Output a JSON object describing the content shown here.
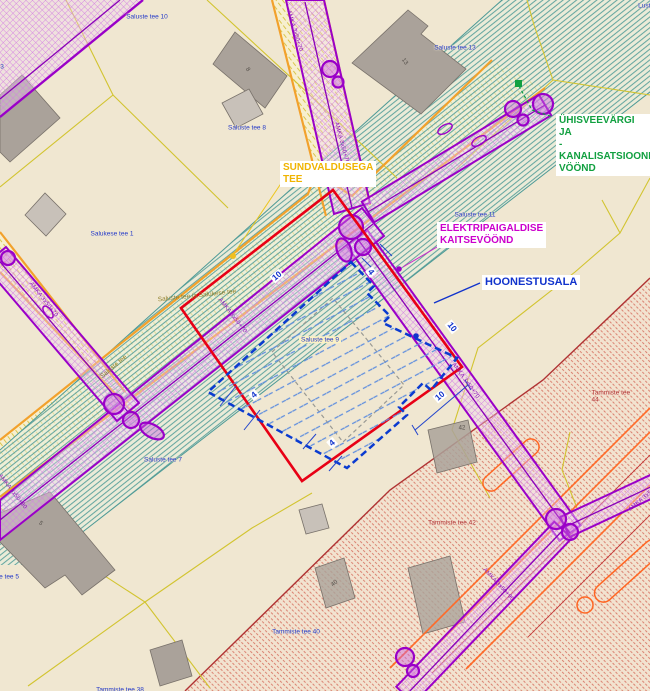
{
  "map": {
    "description": "Detail plan map view",
    "background_color": "#f0e7d1",
    "labels": [
      {
        "name": "parcel-saluste-tee-10",
        "type": "parcel",
        "text": "Saluste tee 10",
        "x": 147,
        "y": 17,
        "rot": 0
      },
      {
        "name": "parcel-saluste-tee-13",
        "type": "parcel",
        "text": "Saluste tee 13",
        "x": 455,
        "y": 48,
        "rot": 0
      },
      {
        "name": "parcel-saluste-tee-8",
        "type": "parcel",
        "text": "Saluste tee 8",
        "x": 247,
        "y": 128,
        "rot": 0
      },
      {
        "name": "parcel-salukese-tee-1",
        "type": "parcel",
        "text": "Salukese tee 1",
        "x": 112,
        "y": 234,
        "rot": 0
      },
      {
        "name": "parcel-saluste-tee-11",
        "type": "parcel",
        "text": "Saluste tee 11",
        "x": 475,
        "y": 215,
        "rot": 0
      },
      {
        "name": "parcel-saluste-tee-9",
        "type": "parcel-hl",
        "text": "Saluste tee 9",
        "x": 320,
        "y": 340,
        "rot": 0
      },
      {
        "name": "parcel-saluste-tee-7",
        "type": "parcel",
        "text": "Saluste tee 7",
        "x": 163,
        "y": 460,
        "rot": 0
      },
      {
        "name": "parcel-saluste-tee-5",
        "type": "parcel",
        "text": "Saluste tee 5",
        "x": 0,
        "y": 577,
        "rot": 0
      },
      {
        "name": "parcel-tammiste-tee-40",
        "type": "parcel",
        "text": "Tammiste tee 40",
        "x": 296,
        "y": 632,
        "rot": 0
      },
      {
        "name": "parcel-tammiste-tee-38",
        "type": "parcel",
        "text": "Tammiste tee 38",
        "x": 120,
        "y": 690,
        "rot": 0
      },
      {
        "name": "parcel-tammiste-tee-42",
        "type": "parcel-red",
        "text": "Tammiste tee 42",
        "x": 452,
        "y": 523,
        "rot": 0
      },
      {
        "name": "parcel-tammiste-tee-44",
        "type": "parcel-red",
        "text": "Tammiste tee 44",
        "x": 611,
        "y": 397,
        "rot": 0
      },
      {
        "name": "parcel-3-partial",
        "type": "parcel",
        "text": "3",
        "x": 2,
        "y": 67,
        "rot": 0
      },
      {
        "name": "parcel-lusti-partial",
        "type": "parcel",
        "text": "Lusti",
        "x": 645,
        "y": 6,
        "rot": 0
      },
      {
        "name": "road-name-saluste-tee",
        "type": "roadname",
        "text": "Saluste tee",
        "x": 114,
        "y": 367,
        "rot": -40
      },
      {
        "name": "road-name-saluste-ja-salukese",
        "type": "roadname",
        "text": "Saluste tee ja Salukese tee",
        "x": 197,
        "y": 296,
        "rot": -6
      },
      {
        "name": "cable-label-a1-top",
        "type": "cable",
        "text": "AMKA 3x50+70",
        "x": 294,
        "y": 31,
        "rot": 73
      },
      {
        "name": "cable-label-a1-mid",
        "type": "cable",
        "text": "AMKA 3x50+70",
        "x": 341,
        "y": 143,
        "rot": 75
      },
      {
        "name": "cable-label-c",
        "type": "cable",
        "text": "AMKA 3x50+70",
        "x": 43,
        "y": 300,
        "rot": 52
      },
      {
        "name": "cable-label-b-mid",
        "type": "cable",
        "text": "AMKA 3x50+70",
        "x": 232,
        "y": 316,
        "rot": 52
      },
      {
        "name": "cable-label-a2",
        "type": "cable",
        "text": "AMKA 3x50+70",
        "x": 465,
        "y": 381,
        "rot": 54
      },
      {
        "name": "cable-label-d2",
        "type": "cable",
        "text": "AMKA 3x50+90",
        "x": 498,
        "y": 585,
        "rot": 47
      },
      {
        "name": "cable-label-b-left",
        "type": "cable",
        "text": "AMKA 3x50+90",
        "x": 12,
        "y": 492,
        "rot": 52
      },
      {
        "name": "cable-label-d3",
        "type": "cable",
        "text": "AMKA 3x50+70",
        "x": 646,
        "y": 497,
        "rot": -40
      },
      {
        "name": "measure-10-nw",
        "type": "measure",
        "text": "10",
        "x": 277,
        "y": 276,
        "rot": -40
      },
      {
        "name": "measure-4-top",
        "type": "measure",
        "text": "4",
        "x": 371,
        "y": 272,
        "rot": 52
      },
      {
        "name": "measure-10-corridor",
        "type": "measure",
        "text": "10",
        "x": 452,
        "y": 327,
        "rot": 52
      },
      {
        "name": "measure-10-se",
        "type": "measure",
        "text": "10",
        "x": 440,
        "y": 396,
        "rot": -40
      },
      {
        "name": "measure-4-w",
        "type": "measure",
        "text": "4",
        "x": 254,
        "y": 395,
        "rot": -40
      },
      {
        "name": "measure-4-s",
        "type": "measure",
        "text": "4",
        "x": 332,
        "y": 443,
        "rot": -40
      },
      {
        "name": "callout-sundvaldusega-tee",
        "type": "callout callout-orange",
        "text": "SUNDVALDUSEGA\nTEE",
        "x": 280,
        "y": 161,
        "rot": 0,
        "anchor": "tl"
      },
      {
        "name": "callout-uhisveevargi",
        "type": "callout callout-green",
        "text": "ÜHISVEEVÄRGI\nJA\n-KANALISATSIOONI\nVÖÖND",
        "x": 556,
        "y": 114,
        "rot": 0,
        "anchor": "tl"
      },
      {
        "name": "callout-elektripaigaldise",
        "type": "callout callout-magenta",
        "text": "ELEKTRIPAIGALDISE\nKAITSEVÖÖND",
        "x": 437,
        "y": 222,
        "rot": 0,
        "anchor": "tl"
      },
      {
        "name": "callout-hoonestusala",
        "type": "callout callout-blue",
        "text": "HOONESTUSALA",
        "x": 482,
        "y": 275,
        "rot": 0,
        "anchor": "tl"
      },
      {
        "name": "building-number-13",
        "type": "bldgnum",
        "text": "13",
        "x": 404,
        "y": 62,
        "rot": 55
      },
      {
        "name": "building-number-5",
        "type": "bldgnum",
        "text": "5",
        "x": 40,
        "y": 524,
        "rot": 45
      },
      {
        "name": "building-number-8",
        "type": "bldgnum",
        "text": "8",
        "x": 247,
        "y": 70,
        "rot": 55
      },
      {
        "name": "building-number-40",
        "type": "bldgnum",
        "text": "40",
        "x": 335,
        "y": 584,
        "rot": -40
      },
      {
        "name": "building-number-42",
        "type": "bldgnum",
        "text": "42",
        "x": 462,
        "y": 429,
        "rot": 0
      }
    ],
    "legend_meaning": {
      "red_outline": "planning area boundary",
      "blue_dashed_area": "HOONESTUSALA",
      "purple_corridors": "ELEKTRIPAIGALDISE KAITSEVÖÖND",
      "green_band": "ÜHISVEEVÄRGI JA -KANALISATSIOONI VÖÖND",
      "orange_road": "SUNDVALDUSEGA TEE"
    },
    "colors": {
      "red_boundary": "#e80015",
      "blue_area": "#0b3bd0",
      "purple_corridor": "#9a00c8",
      "orange_road_border": "#f2a12c",
      "teal_band": "#4e9a96",
      "green_callout": "#11a040",
      "magenta_callout": "#cc00cc",
      "orange_callout": "#f0b400",
      "parcel_line": "#d2c430",
      "building_gray": "#aaa29a",
      "red_zone_hatch": "#d46a5a"
    }
  }
}
